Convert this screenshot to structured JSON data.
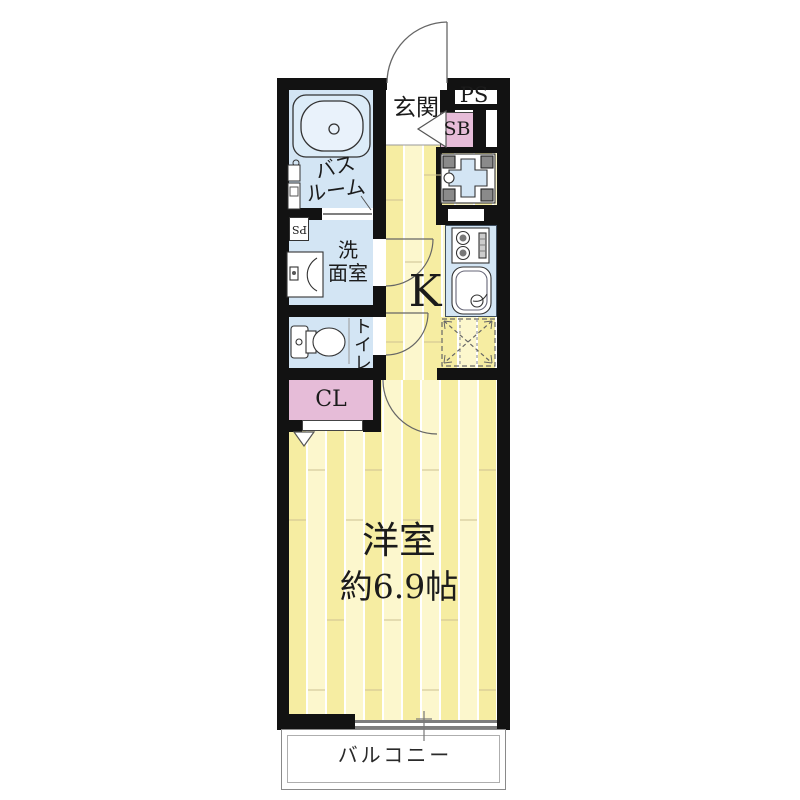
{
  "floorplan": {
    "labels": {
      "entrance": "玄関",
      "pipe_space": "PS",
      "pipe_space_small": "PS",
      "shoe_box": "SB",
      "bath_line1": "バス",
      "bath_line2": "ルーム",
      "wash_line1": "洗",
      "wash_line2": "面室",
      "toilet": "トイレ",
      "closet": "CL",
      "kitchen": "K",
      "main_room": "洋室",
      "main_room_size": "約6.9帖",
      "balcony": "バルコニー"
    },
    "colors": {
      "wall": "#121212",
      "wet_area_blue": "#d3e5f4",
      "storage_pink": "#e6bcd8",
      "floor_plank_dark": "#f6eda2",
      "floor_plank_light": "#fcf7cd"
    }
  }
}
